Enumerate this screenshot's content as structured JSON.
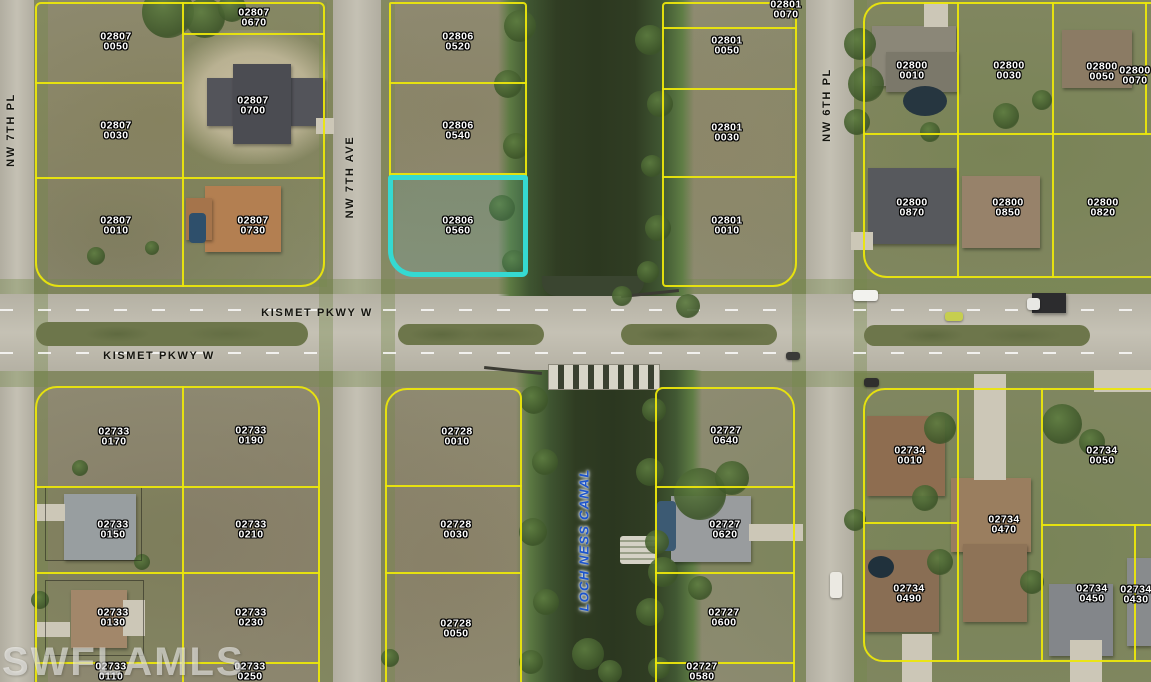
{
  "map": {
    "watermark": "SWFLAMLS",
    "highlighted_parcel": {
      "line1": "02806",
      "line2": "0560",
      "outline_color": "#35d9d2",
      "label_x": 458,
      "label_y": 226
    },
    "street_labels": [
      {
        "text": "NW 7TH PL",
        "x": 11,
        "y": 130,
        "vertical": true,
        "style": "street"
      },
      {
        "text": "NW 7TH AVE",
        "x": 350,
        "y": 177,
        "vertical": true,
        "style": "street"
      },
      {
        "text": "NW 6TH PL",
        "x": 827,
        "y": 105,
        "vertical": true,
        "style": "street"
      },
      {
        "text": "KISMET PKWY W",
        "x": 317,
        "y": 313,
        "vertical": false,
        "style": "street"
      },
      {
        "text": "KISMET PKWY W",
        "x": 159,
        "y": 356,
        "vertical": false,
        "style": "street"
      },
      {
        "text": "LOCH NESS CANAL",
        "x": 584,
        "y": 540,
        "vertical": true,
        "style": "canal"
      }
    ],
    "parcels": [
      {
        "line1": "02807",
        "line2": "0050",
        "x": 116,
        "y": 42
      },
      {
        "line1": "02807",
        "line2": "0670",
        "x": 254,
        "y": 18
      },
      {
        "line1": "02807",
        "line2": "0030",
        "x": 116,
        "y": 131
      },
      {
        "line1": "02807",
        "line2": "0700",
        "x": 253,
        "y": 106
      },
      {
        "line1": "02807",
        "line2": "0010",
        "x": 116,
        "y": 226
      },
      {
        "line1": "02807",
        "line2": "0730",
        "x": 253,
        "y": 226
      },
      {
        "line1": "02806",
        "line2": "0520",
        "x": 458,
        "y": 42
      },
      {
        "line1": "02806",
        "line2": "0540",
        "x": 458,
        "y": 131
      },
      {
        "line1": "02801",
        "line2": "0070",
        "x": 786,
        "y": 10
      },
      {
        "line1": "02801",
        "line2": "0050",
        "x": 727,
        "y": 46
      },
      {
        "line1": "02801",
        "line2": "0030",
        "x": 727,
        "y": 133
      },
      {
        "line1": "02801",
        "line2": "0010",
        "x": 727,
        "y": 226
      },
      {
        "line1": "02800",
        "line2": "0010",
        "x": 912,
        "y": 71
      },
      {
        "line1": "02800",
        "line2": "0030",
        "x": 1009,
        "y": 71
      },
      {
        "line1": "02800",
        "line2": "0050",
        "x": 1102,
        "y": 72
      },
      {
        "line1": "02800",
        "line2": "0070",
        "x": 1135,
        "y": 76
      },
      {
        "line1": "02800",
        "line2": "0870",
        "x": 912,
        "y": 208
      },
      {
        "line1": "02800",
        "line2": "0850",
        "x": 1008,
        "y": 208
      },
      {
        "line1": "02800",
        "line2": "0820",
        "x": 1103,
        "y": 208
      },
      {
        "line1": "02733",
        "line2": "0170",
        "x": 114,
        "y": 437
      },
      {
        "line1": "02733",
        "line2": "0190",
        "x": 251,
        "y": 436
      },
      {
        "line1": "02733",
        "line2": "0150",
        "x": 113,
        "y": 530
      },
      {
        "line1": "02733",
        "line2": "0210",
        "x": 251,
        "y": 530
      },
      {
        "line1": "02733",
        "line2": "0130",
        "x": 113,
        "y": 618
      },
      {
        "line1": "02733",
        "line2": "0230",
        "x": 251,
        "y": 618
      },
      {
        "line1": "02733",
        "line2": "0110",
        "x": 111,
        "y": 672
      },
      {
        "line1": "02733",
        "line2": "0250",
        "x": 250,
        "y": 672
      },
      {
        "line1": "02728",
        "line2": "0010",
        "x": 457,
        "y": 437
      },
      {
        "line1": "02728",
        "line2": "0030",
        "x": 456,
        "y": 530
      },
      {
        "line1": "02728",
        "line2": "0050",
        "x": 456,
        "y": 629
      },
      {
        "line1": "02727",
        "line2": "0640",
        "x": 726,
        "y": 436
      },
      {
        "line1": "02727",
        "line2": "0620",
        "x": 725,
        "y": 530
      },
      {
        "line1": "02727",
        "line2": "0600",
        "x": 724,
        "y": 618
      },
      {
        "line1": "02727",
        "line2": "0580",
        "x": 702,
        "y": 672
      },
      {
        "line1": "02734",
        "line2": "0010",
        "x": 910,
        "y": 456
      },
      {
        "line1": "02734",
        "line2": "0050",
        "x": 1102,
        "y": 456
      },
      {
        "line1": "02734",
        "line2": "0470",
        "x": 1004,
        "y": 525
      },
      {
        "line1": "02734",
        "line2": "0490",
        "x": 909,
        "y": 594
      },
      {
        "line1": "02734",
        "line2": "0450",
        "x": 1092,
        "y": 594
      },
      {
        "line1": "02734",
        "line2": "0430",
        "x": 1136,
        "y": 595
      }
    ]
  }
}
